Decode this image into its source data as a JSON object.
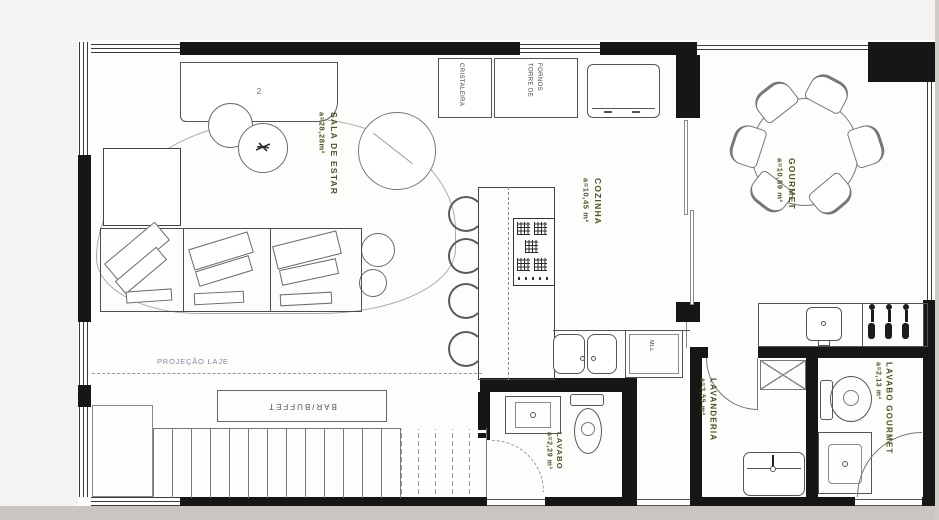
{
  "drawing": {
    "rooms": [
      {
        "id": "sala_de_estar",
        "name": "SALA DE ESTAR",
        "area": "a=28,28m²"
      },
      {
        "id": "cozinha",
        "name": "COZINHA",
        "area": "a=10,45 m²"
      },
      {
        "id": "gourmet",
        "name": "GOURMET",
        "area": "a=10,89 m²"
      },
      {
        "id": "lavabo",
        "name": "LAVABO",
        "area": "a=2,29 m²"
      },
      {
        "id": "lavanderia",
        "name": "LAVANDERIA",
        "area": "a=3,55 m²"
      },
      {
        "id": "lavabo_gourmet",
        "name": "LAVABO GOURMET",
        "area": "a=2,13 m²"
      }
    ],
    "labels": {
      "projecao_laje": "PROJEÇÃO LAJE",
      "bar_buffet": "BAR/BUFFET",
      "cristaleira": "CRISTALEIRA",
      "torre_de_fornos_line1": "TORRE DE",
      "torre_de_fornos_line2": "FORNOS",
      "dishwasher": "MLL",
      "rack_item_count": "2"
    },
    "colors": {
      "room_label": "#46551d",
      "projection_label": "#7e8aa8",
      "wall": "#161616",
      "furniture_line": "#666666",
      "paper": "#fdfdfc",
      "backdrop": "#d8d5d1"
    }
  }
}
